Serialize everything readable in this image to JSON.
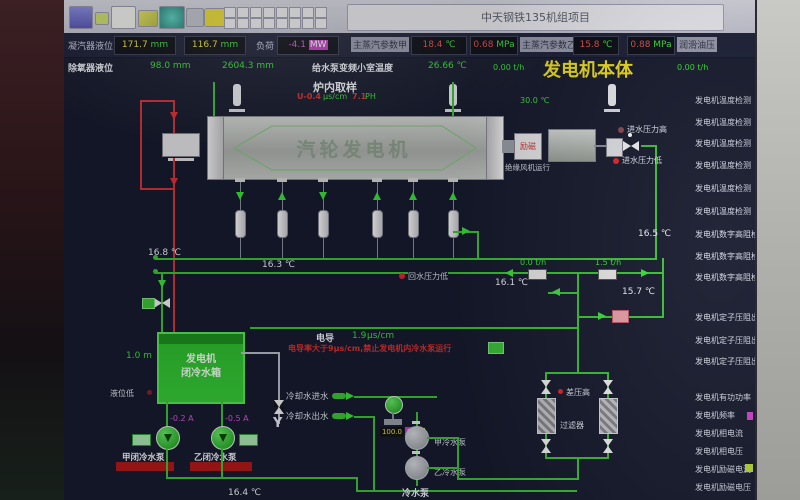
{
  "window": {
    "title": "中天钢铁135机组项目"
  },
  "toolbar": {
    "icons": [
      "display-icon",
      "note-icon",
      "image-icon",
      "chart-icon",
      "recycle-icon",
      "link-icon",
      "trend-icon"
    ],
    "grid_buttons": 16
  },
  "status_bar": {
    "row1": {
      "level_label": "凝汽器液位",
      "level1": "171.7",
      "level1_unit": "mm",
      "level2": "116.7",
      "level2_unit": "mm",
      "load_label": "负荷",
      "load": "-4.1",
      "load_unit": "MW",
      "steam_a_label": "主蒸汽参数甲",
      "steam_a_temp": "18.4",
      "steam_a_temp_unit": "℃",
      "steam_a_press": "0.68",
      "steam_a_press_unit": "MPa",
      "steam_b_label": "主蒸汽参数乙",
      "steam_b_temp": "15.8",
      "steam_b_temp_unit": "℃",
      "steam_b_press": "0.88",
      "steam_b_press_unit": "MPa",
      "lube_label": "润滑油压"
    },
    "row2": {
      "deaerator_label": "除氧器液位",
      "deaerator1": "98.0",
      "deaerator1_unit": "mm",
      "deaerator2": "2604.3",
      "deaerator2_unit": "mm",
      "pump_room_label": "给水泵变频小室温度",
      "pump_room_temp": "26.66",
      "pump_room_temp_unit": "℃",
      "flow_left": "0.00 t/h",
      "flow_right": "0.00 t/h"
    }
  },
  "page": {
    "title": "发电机本体",
    "temp_top": "30.0 ℃"
  },
  "sampling": {
    "title": "炉内取样",
    "conductivity": "U-0.4",
    "conductivity_unit": "μs/cm",
    "ph": "7.1",
    "ph_unit": "PH"
  },
  "generator": {
    "label": "汽轮发电机",
    "exciter_label": "励磁",
    "fan_status": "绝缘风机运行"
  },
  "alarms": {
    "inlet_high": "进水压力高",
    "inlet_low": "进水压力低",
    "return_low": "回水压力低",
    "dp_high": "差压高",
    "level_low": "液位低"
  },
  "temps": {
    "t_left": "16.8 ℃",
    "t_header": "16.3 ℃",
    "t_right": "16.5 ℃",
    "t_return": "16.1 ℃",
    "t_branch": "15.7 ℃",
    "t_bottom": "16.4 ℃"
  },
  "flows": {
    "f1": "0.0 t/h",
    "f2": "1.5 t/h"
  },
  "tank": {
    "line1": "发电机",
    "line2": "闭冷水箱",
    "level": "1.0 m"
  },
  "pumps_closed": {
    "a_label": "甲闭冷水泵",
    "a_current": "-0.2 A",
    "b_label": "乙闭冷水泵",
    "b_current": "-0.5 A"
  },
  "conductivity": {
    "label": "电导",
    "value": "1.9",
    "unit": "μs/cm",
    "warning": "电导率大于9μs/cm,禁止发电机内冷水泵运行"
  },
  "cooling": {
    "inlet": "冷却水进水",
    "outlet": "冷却水出水",
    "valve_opening": "100.0",
    "valve_unit": "%"
  },
  "pumps_cooling": {
    "a_label": "甲冷水泵",
    "b_label": "乙冷水泵",
    "bottom_label": "冷水泵"
  },
  "filter": {
    "label": "过滤器"
  },
  "strainer": {
    "glyph": "Y"
  },
  "sidebar": {
    "items": [
      "发电机温度检测",
      "发电机温度检测",
      "发电机温度检测",
      "发电机温度检测",
      "发电机温度检测",
      "发电机温度检测",
      "发电机数字高阻检测",
      "发电机数字高阻检测",
      "发电机数字高阻检测",
      "发电机定子压阻出口",
      "发电机定子压阻出口",
      "发电机定子压阻出口",
      "发电机有功功率",
      "发电机频率",
      "发电机相电流",
      "发电机相电压",
      "发电机励磁电流",
      "发电机励磁电压"
    ]
  }
}
